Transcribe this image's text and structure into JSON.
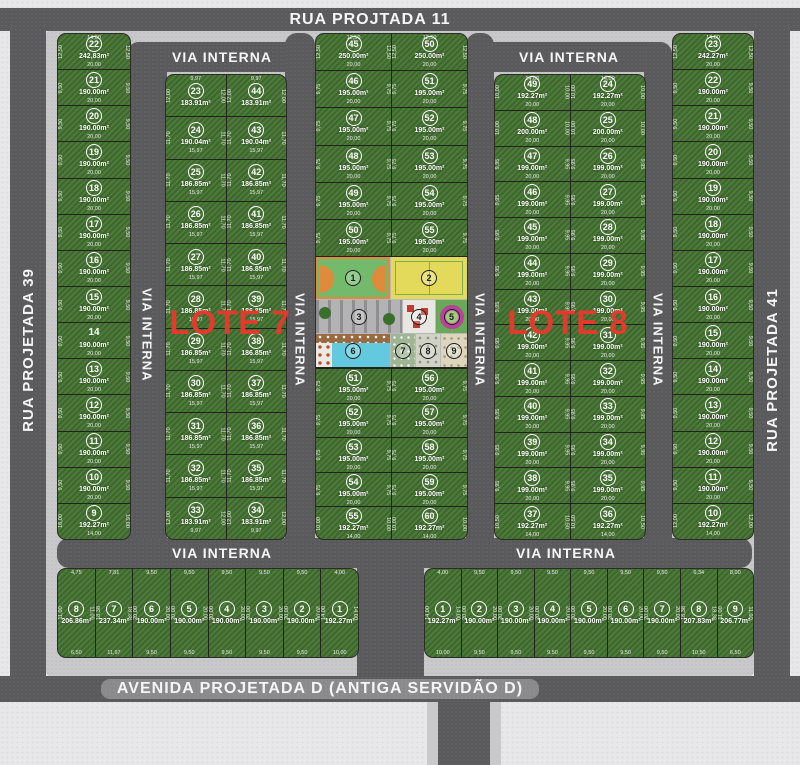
{
  "streets": {
    "top": "RUA PROJTADA 11",
    "left": "RUA PROJETADA 39",
    "right": "RUA PROJETADA 41",
    "bottom": "AVENIDA PROJETADA D (ANTIGA SERVIDÃO D)",
    "internal": "VIA INTERNA"
  },
  "red_labels": {
    "lote7": "LOTE 7",
    "lote8": "LOTE 8"
  },
  "colors": {
    "grass": "#447331",
    "road": "#5a5a5c",
    "sidewalk": "#c9c9cb",
    "background": "#e8e8ea",
    "lot_line": "#23231e",
    "text": "#ffffff",
    "red_label": "#e23a2c",
    "court_green": "#74ba6c",
    "court_orange": "#e08a3c",
    "court_yellow": "#e3da5c",
    "pool_blue": "#62c9de",
    "deck_brown": "#9a6a42",
    "garden_magenta": "#b8439b",
    "parking_gray": "#b3b3b5",
    "sand": "#ddd6bd"
  },
  "blocks": {
    "left_col": [
      {
        "n": "22",
        "a": "242,83m²",
        "t": "14,00",
        "w": "20,00",
        "s": "12,50"
      },
      {
        "n": "21",
        "a": "190.00m²",
        "w": "20,00",
        "s": "9,50"
      },
      {
        "n": "20",
        "a": "190.00m²",
        "w": "20,00",
        "s": "9,50"
      },
      {
        "n": "19",
        "a": "190.00m²",
        "w": "20,00",
        "s": "9,50"
      },
      {
        "n": "18",
        "a": "190.00m²",
        "w": "20,00",
        "s": "9,50"
      },
      {
        "n": "17",
        "a": "190.00m²",
        "w": "20,00",
        "s": "9,50"
      },
      {
        "n": "16",
        "a": "190.00m²",
        "w": "20,00",
        "s": "9,50"
      },
      {
        "n": "15",
        "a": "190.00m²",
        "w": "20,00",
        "s": "9,50"
      },
      {
        "n": "14",
        "a": "190.00m²",
        "w": "20,00",
        "s": "9,50",
        "nc": true
      },
      {
        "n": "13",
        "a": "190.00m²",
        "w": "20,00",
        "s": "9,50"
      },
      {
        "n": "12",
        "a": "190.00m²",
        "w": "20,00",
        "s": "9,50"
      },
      {
        "n": "11",
        "a": "190.00m²",
        "w": "20,00",
        "s": "9,50"
      },
      {
        "n": "10",
        "a": "190.00m²",
        "w": "20,00",
        "s": "9,50"
      },
      {
        "n": "9",
        "a": "192.27m²",
        "w": "14,00",
        "s": "16,00"
      }
    ],
    "lote7_left": [
      {
        "n": "23",
        "a": "183.91m²",
        "t": "9,97",
        "s": "12,00"
      },
      {
        "n": "24",
        "a": "190.04m²",
        "w": "15,97",
        "s": "11,70"
      },
      {
        "n": "25",
        "a": "186.85m²",
        "w": "15,97",
        "s": "11,70"
      },
      {
        "n": "26",
        "a": "186.85m²",
        "w": "15,97",
        "s": "11,70"
      },
      {
        "n": "27",
        "a": "186.85m²",
        "w": "15,97",
        "s": "11,70"
      },
      {
        "n": "28",
        "a": "186.85m²",
        "w": "15,97",
        "s": "11,70"
      },
      {
        "n": "29",
        "a": "186.85m²",
        "w": "15,97",
        "s": "11,70"
      },
      {
        "n": "30",
        "a": "186.85m²",
        "w": "15,97",
        "s": "11,70"
      },
      {
        "n": "31",
        "a": "186.85m²",
        "w": "15,97",
        "s": "11,70"
      },
      {
        "n": "32",
        "a": "186.85m²",
        "w": "15,97",
        "s": "11,70"
      },
      {
        "n": "33",
        "a": "183.91m²",
        "w": "9,97",
        "s": "12,00"
      }
    ],
    "lote7_right": [
      {
        "n": "44",
        "a": "183.91m²",
        "t": "9,97",
        "s": "12,00"
      },
      {
        "n": "43",
        "a": "190.04m²",
        "w": "15,97",
        "s": "11,70"
      },
      {
        "n": "42",
        "a": "186.85m²",
        "w": "15,97",
        "s": "11,70"
      },
      {
        "n": "41",
        "a": "186.85m²",
        "w": "15,97",
        "s": "11,70"
      },
      {
        "n": "40",
        "a": "186.85m²",
        "w": "15,97",
        "s": "11,70"
      },
      {
        "n": "39",
        "a": "186.85m²",
        "w": "15,97",
        "s": "11,70"
      },
      {
        "n": "38",
        "a": "186.85m²",
        "w": "15,97",
        "s": "11,70"
      },
      {
        "n": "37",
        "a": "186.85m²",
        "w": "15,97",
        "s": "11,70"
      },
      {
        "n": "36",
        "a": "186.85m²",
        "w": "15,97",
        "s": "11,70"
      },
      {
        "n": "35",
        "a": "186.85m²",
        "w": "15,97",
        "s": "11,70"
      },
      {
        "n": "34",
        "a": "183.91m²",
        "w": "9,97",
        "s": "12,00"
      }
    ],
    "mid_top_left": [
      {
        "n": "45",
        "a": "250.00m²",
        "t": "12,50",
        "w": "20,00",
        "s": "12,50"
      },
      {
        "n": "46",
        "a": "195.00m²",
        "w": "20,00",
        "s": "9,75"
      },
      {
        "n": "47",
        "a": "195.00m²",
        "w": "20,00",
        "s": "9,75"
      },
      {
        "n": "48",
        "a": "195.00m²",
        "w": "20,00",
        "s": "9,75"
      },
      {
        "n": "49",
        "a": "195.00m²",
        "w": "20,00",
        "s": "9,75"
      },
      {
        "n": "50",
        "a": "195.00m²",
        "w": "20,00",
        "s": "9,75"
      }
    ],
    "mid_top_right": [
      {
        "n": "50",
        "a": "250.00m²",
        "t": "12,50",
        "w": "20,00",
        "s": "12,50"
      },
      {
        "n": "51",
        "a": "195.00m²",
        "w": "20,00",
        "s": "9,75"
      },
      {
        "n": "52",
        "a": "195.00m²",
        "w": "20,00",
        "s": "9,75"
      },
      {
        "n": "53",
        "a": "195.00m²",
        "w": "20,00",
        "s": "9,75"
      },
      {
        "n": "54",
        "a": "195.00m²",
        "w": "20,00",
        "s": "9,75"
      },
      {
        "n": "55",
        "a": "195.00m²",
        "w": "20,00",
        "s": "9,75"
      }
    ],
    "mid_bot_left": [
      {
        "n": "51",
        "a": "195.00m²",
        "w": "20,00",
        "s": "9,75"
      },
      {
        "n": "52",
        "a": "195.00m²",
        "w": "20,00",
        "s": "9,75"
      },
      {
        "n": "53",
        "a": "195.00m²",
        "w": "20,00",
        "s": "9,75"
      },
      {
        "n": "54",
        "a": "195.00m²",
        "w": "20,00",
        "s": "9,75"
      },
      {
        "n": "55",
        "a": "192.27m²",
        "w": "14,00",
        "s": "10,00"
      }
    ],
    "mid_bot_right": [
      {
        "n": "56",
        "a": "195.00m²",
        "w": "20,00",
        "s": "9,75"
      },
      {
        "n": "57",
        "a": "195.00m²",
        "w": "20,00",
        "s": "9,75"
      },
      {
        "n": "58",
        "a": "195.00m²",
        "w": "20,00",
        "s": "9,75"
      },
      {
        "n": "59",
        "a": "195.00m²",
        "w": "20,00",
        "s": "9,75"
      },
      {
        "n": "60",
        "a": "192.27m²",
        "w": "14,00",
        "s": "10,00"
      }
    ],
    "lote8_left": [
      {
        "n": "49",
        "a": "192.27m²",
        "t": "14,00",
        "w": "20,00",
        "s": "10,00"
      },
      {
        "n": "48",
        "a": "200.00m²",
        "w": "20,00",
        "s": "10,00"
      },
      {
        "n": "47",
        "a": "199.00m²",
        "w": "20,00",
        "s": "9,95"
      },
      {
        "n": "46",
        "a": "199.00m²",
        "w": "20,00",
        "s": "9,95"
      },
      {
        "n": "45",
        "a": "199.00m²",
        "w": "20,00",
        "s": "9,95"
      },
      {
        "n": "44",
        "a": "199.00m²",
        "w": "20,00",
        "s": "9,95"
      },
      {
        "n": "43",
        "a": "199.00m²",
        "w": "20,00",
        "s": "9,95"
      },
      {
        "n": "42",
        "a": "199.00m²",
        "w": "20,00",
        "s": "9,95"
      },
      {
        "n": "41",
        "a": "199.00m²",
        "w": "20,00",
        "s": "9,95"
      },
      {
        "n": "40",
        "a": "199.00m²",
        "w": "20,00",
        "s": "9,95"
      },
      {
        "n": "39",
        "a": "199.00m²",
        "w": "20,00",
        "s": "9,95"
      },
      {
        "n": "38",
        "a": "199.00m²",
        "w": "20,00",
        "s": "9,95"
      },
      {
        "n": "37",
        "a": "192.27m²",
        "w": "14,00",
        "s": "10,50"
      }
    ],
    "lote8_right": [
      {
        "n": "24",
        "a": "192.27m²",
        "t": "14,00",
        "w": "20,00",
        "s": "10,00"
      },
      {
        "n": "25",
        "a": "200.00m²",
        "w": "20,00",
        "s": "10,00"
      },
      {
        "n": "26",
        "a": "199.00m²",
        "w": "20,00",
        "s": "9,95"
      },
      {
        "n": "27",
        "a": "199.00m²",
        "w": "20,00",
        "s": "9,95"
      },
      {
        "n": "28",
        "a": "199.00m²",
        "w": "20,00",
        "s": "9,95"
      },
      {
        "n": "29",
        "a": "199.00m²",
        "w": "20,00",
        "s": "9,95"
      },
      {
        "n": "30",
        "a": "199.00m²",
        "w": "20,00",
        "s": "9,95"
      },
      {
        "n": "31",
        "a": "199.00m²",
        "w": "20,00",
        "s": "9,95"
      },
      {
        "n": "32",
        "a": "199.00m²",
        "w": "20,00",
        "s": "9,95"
      },
      {
        "n": "33",
        "a": "199.00m²",
        "w": "20,00",
        "s": "9,95"
      },
      {
        "n": "34",
        "a": "199.00m²",
        "w": "20,00",
        "s": "9,95"
      },
      {
        "n": "35",
        "a": "199.00m²",
        "w": "20,00",
        "s": "9,95"
      },
      {
        "n": "36",
        "a": "192.27m²",
        "w": "14,00",
        "s": "10,50"
      }
    ],
    "right_col": [
      {
        "n": "23",
        "a": "242.27m²",
        "t": "14,00",
        "w": "20,00",
        "s": "12,50"
      },
      {
        "n": "22",
        "a": "190.00m²",
        "w": "20,00",
        "s": "9,50"
      },
      {
        "n": "21",
        "a": "190.00m²",
        "w": "20,00",
        "s": "9,50"
      },
      {
        "n": "20",
        "a": "190.00m²",
        "w": "20,00",
        "s": "9,50"
      },
      {
        "n": "19",
        "a": "190.00m²",
        "w": "20,00",
        "s": "9,50"
      },
      {
        "n": "18",
        "a": "190.00m²",
        "w": "20,00",
        "s": "9,50"
      },
      {
        "n": "17",
        "a": "190.00m²",
        "w": "20,00",
        "s": "9,50"
      },
      {
        "n": "16",
        "a": "190.00m²",
        "w": "20,00",
        "s": "9,50"
      },
      {
        "n": "15",
        "a": "190.00m²",
        "w": "20,00",
        "s": "9,50"
      },
      {
        "n": "14",
        "a": "190.00m²",
        "w": "20,00",
        "s": "9,50"
      },
      {
        "n": "13",
        "a": "190.00m²",
        "w": "20,00",
        "s": "9,50"
      },
      {
        "n": "12",
        "a": "190.00m²",
        "w": "20,00",
        "s": "9,50"
      },
      {
        "n": "11",
        "a": "190.00m²",
        "w": "20,00",
        "s": "9,50"
      },
      {
        "n": "10",
        "a": "192.27m²",
        "w": "14,00",
        "s": "12,00"
      }
    ],
    "bottom_left": [
      {
        "n": "8",
        "a": "206.86m²",
        "t": "4,75",
        "b": "6,50",
        "s": "11,00"
      },
      {
        "n": "7",
        "a": "237.34m²",
        "t": "7,81",
        "b": "11,97",
        "s": "18,38"
      },
      {
        "n": "6",
        "a": "190.00m²",
        "t": "9,50",
        "b": "9,50",
        "s": "20,00"
      },
      {
        "n": "5",
        "a": "190.00m²",
        "t": "9,50",
        "b": "9,50",
        "s": "20,00"
      },
      {
        "n": "4",
        "a": "190.00m²",
        "t": "9,50",
        "b": "9,50",
        "s": "20,00"
      },
      {
        "n": "3",
        "a": "190.00m²",
        "t": "9,50",
        "b": "9,50",
        "s": "20,00"
      },
      {
        "n": "2",
        "a": "190.00m²",
        "t": "9,50",
        "b": "9,50",
        "s": "20,00"
      },
      {
        "n": "1",
        "a": "192.27m²",
        "t": "4,00",
        "b": "10,00",
        "s": "14,00"
      }
    ],
    "bottom_right": [
      {
        "n": "1",
        "a": "192.27m²",
        "t": "4,00",
        "b": "10,00",
        "s": "14,00"
      },
      {
        "n": "2",
        "a": "190.00m²",
        "t": "9,50",
        "b": "9,50",
        "s": "20,00"
      },
      {
        "n": "3",
        "a": "190.00m²",
        "t": "9,50",
        "b": "9,50",
        "s": "20,00"
      },
      {
        "n": "4",
        "a": "190.00m²",
        "t": "9,50",
        "b": "9,50",
        "s": "20,00"
      },
      {
        "n": "5",
        "a": "190.00m²",
        "t": "9,50",
        "b": "9,50",
        "s": "20,00"
      },
      {
        "n": "6",
        "a": "190.00m²",
        "t": "9,50",
        "b": "9,50",
        "s": "20,00"
      },
      {
        "n": "7",
        "a": "190.00m²",
        "t": "9,50",
        "b": "9,50",
        "s": "20,00"
      },
      {
        "n": "8",
        "a": "207.83m²",
        "t": "6,34",
        "b": "10,50",
        "s": "18,38"
      },
      {
        "n": "9",
        "a": "206.77m²",
        "t": "8,00",
        "b": "6,50",
        "s": "11,00"
      }
    ]
  },
  "amenities": [
    {
      "n": "1",
      "name": "sports-court"
    },
    {
      "n": "2",
      "name": "multi-sport-court"
    },
    {
      "n": "3",
      "name": "parking-area"
    },
    {
      "n": "4",
      "name": "playground"
    },
    {
      "n": "5",
      "name": "flower-garden"
    },
    {
      "n": "6",
      "name": "swimming-pool"
    },
    {
      "n": "7",
      "name": "gym-area"
    },
    {
      "n": "8",
      "name": "play-equipment-area"
    },
    {
      "n": "9",
      "name": "sand-play-area"
    }
  ]
}
